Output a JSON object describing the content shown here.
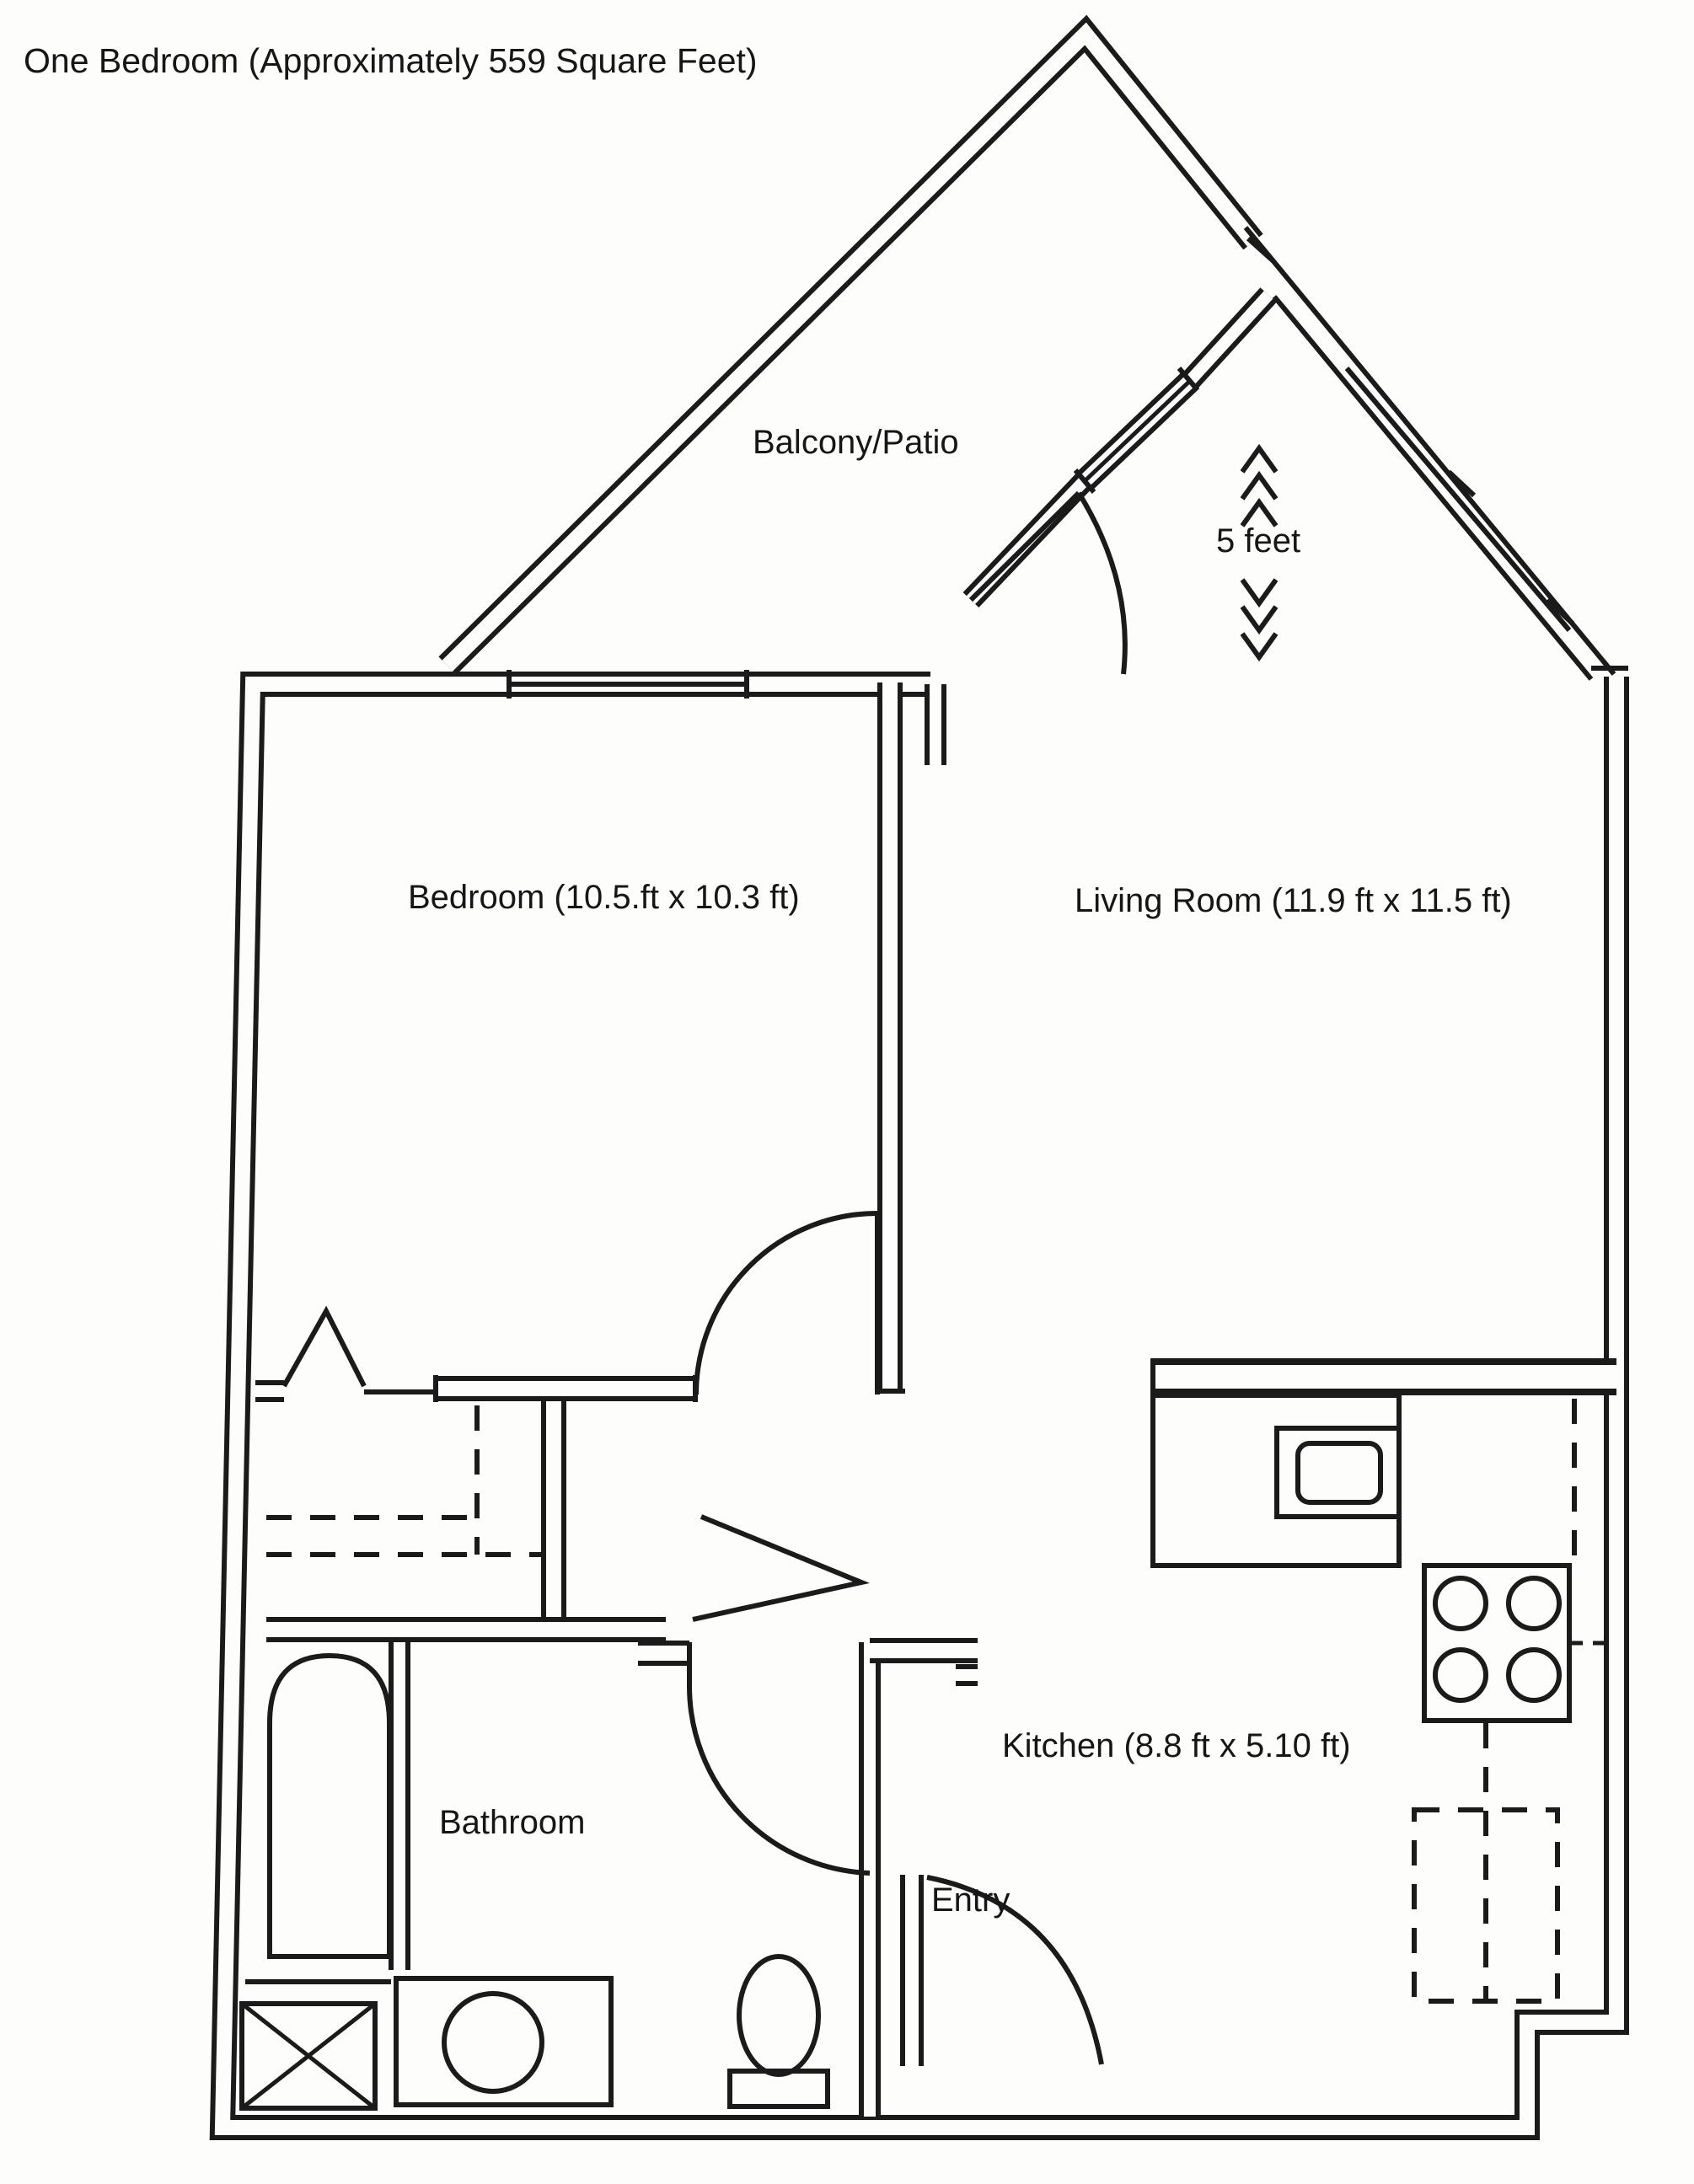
{
  "page": {
    "background": "#fdfdfc",
    "line_color": "#1b1b1b",
    "type": "floor-plan scan, black ink on white paper"
  },
  "title": "One Bedroom (Approximately 559 Square Feet)",
  "rooms": {
    "balcony": {
      "label": "Balcony/Patio"
    },
    "bedroom": {
      "label": "Bedroom  (10.5.ft x 10.3 ft)"
    },
    "living_room": {
      "label": "Living Room (11.9 ft x 11.5 ft)"
    },
    "kitchen": {
      "label": "Kitchen  (8.8 ft x 5.10 ft)"
    },
    "bathroom": {
      "label": "Bathroom"
    },
    "entry": {
      "label": "Entry"
    }
  },
  "scale_indicator": {
    "label": "5 feet"
  },
  "fixture_icons": [
    "bathtub-icon",
    "shower-xbox-icon",
    "vanity-sink-icon",
    "toilet-icon",
    "kitchen-counter-icon",
    "kitchen-sink-icon",
    "stove-burners-icon",
    "refrigerator-dashed-icon",
    "closet-dashed-icon",
    "bifold-door-icon",
    "door-swing-arc-icon",
    "window-triple-line-icon",
    "direction-arrow-icon",
    "scale-chevrons-icon"
  ]
}
